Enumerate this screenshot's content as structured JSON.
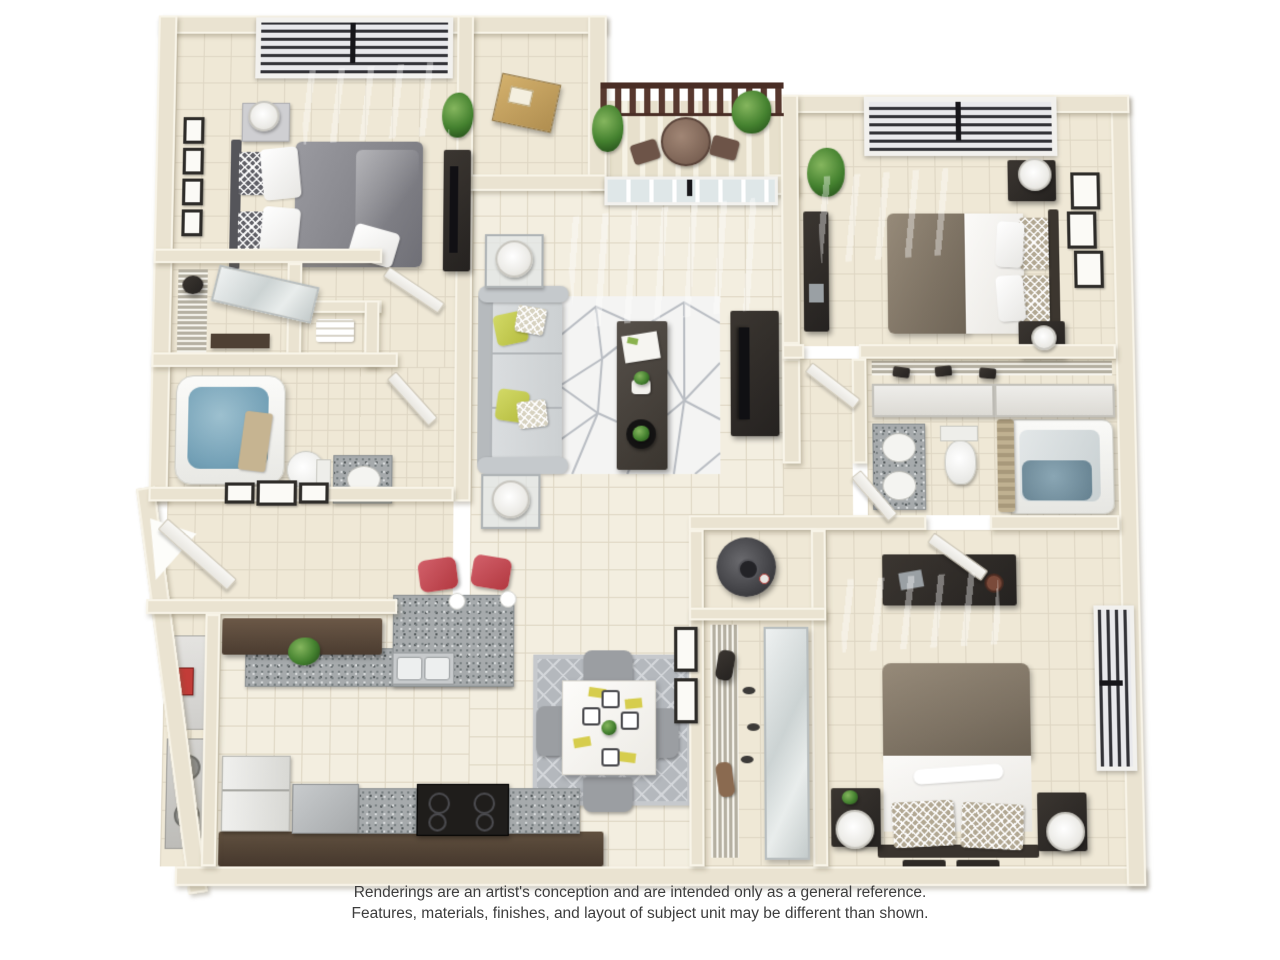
{
  "disclaimer": {
    "line1": "Renderings are an artist's conception and are intended only as a general reference.",
    "line2": "Features, materials, finishes, and layout of subject unit may be different than shown."
  },
  "palette": {
    "background": "#ffffff",
    "wall": "#eae3d1",
    "wall_edge": "#f8f4e8",
    "floor_tile": "#efe8d6",
    "grout": "#ded6c3",
    "granite_counter": "#a6aaac",
    "upper_cabinet_wood": "#5d4b3c",
    "base_cabinet_wood": "#55453a",
    "sofa_gray": "#d6d9db",
    "accent_pillow_yellow": "#c6cc55",
    "bed_duvet_gray": "#8d8d92",
    "bed_duvet_taupe": "#8a7e6e",
    "bar_stool_red": "#c2474e",
    "balcony_railing_brown": "#57382f",
    "bathtub_water_blue": "#7da6ba",
    "living_rug_white": "#f4f4f3",
    "dining_rug_gray": "#b6bac0",
    "plant_green": "#44812f",
    "dark_furniture": "#332e29"
  },
  "scene": {
    "type": "3d-floor-plan-rendering",
    "rooms": [
      "master-bedroom",
      "walk-in-closet",
      "linen-closet",
      "master-bathroom",
      "entry",
      "kitchen",
      "utility-closet",
      "dining-area",
      "living-room",
      "balcony",
      "storage-closet",
      "bedroom-2",
      "bedroom-2-closet",
      "bathroom-2",
      "hall-closet",
      "water-heater-closet",
      "bedroom-3"
    ]
  }
}
